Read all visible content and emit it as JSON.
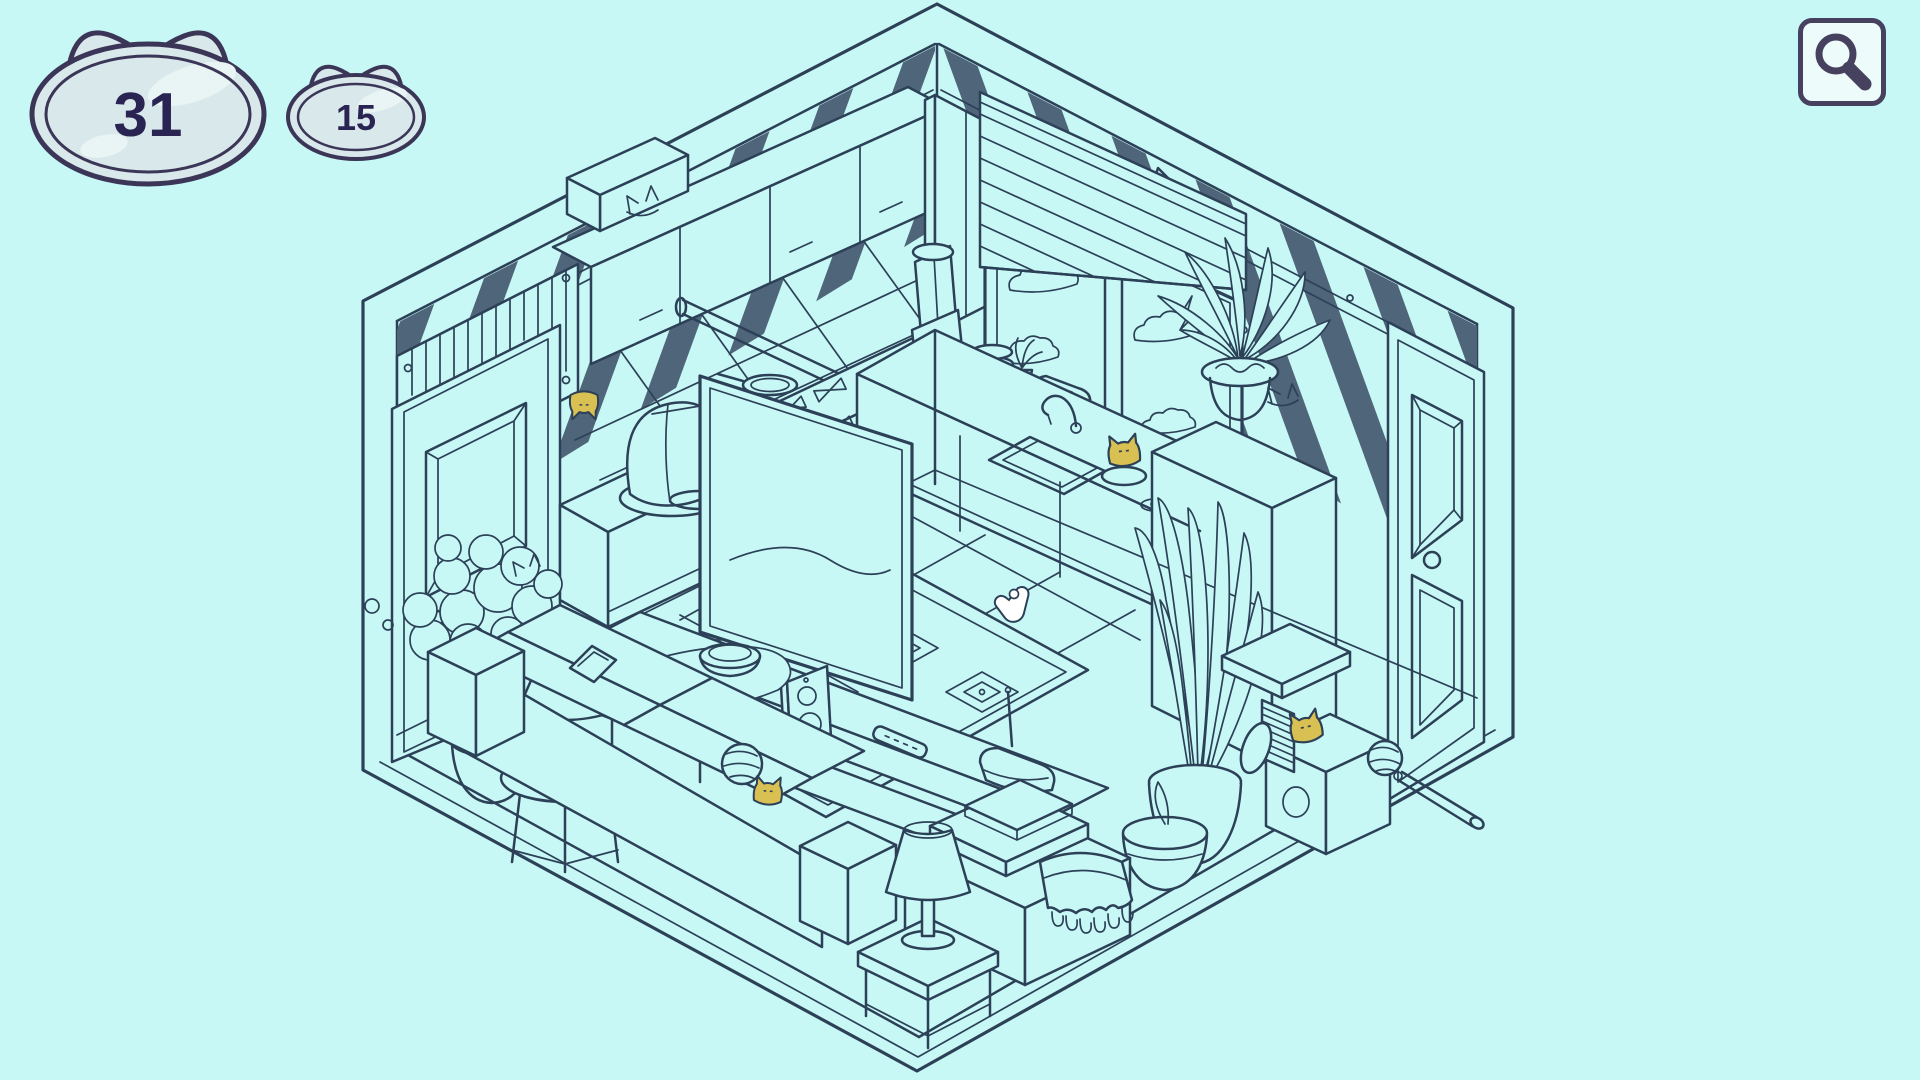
{
  "hud": {
    "large_counter": "31",
    "small_counter": "15"
  },
  "toolbar": {
    "magnifier_icon": "magnifying-glass"
  },
  "colors": {
    "background": "#c7f8f5",
    "line": "#2c4057",
    "wall_stripe": "#4f6579",
    "badge_fill": "#d9e8ea",
    "badge_highlight": "#e9f4f4",
    "badge_border": "#3b3657",
    "badge_text": "#2a2453",
    "found_cat": "#d9c052",
    "button_bg": "#edfbfa",
    "button_border": "#46415f"
  },
  "scene": {
    "description": "isometric line-art room: kitchen with cabinets, window with blinds, fridge, TV on stand, sofa with rug, plants, lamps, cat tree; hidden-cat puzzle",
    "cursor": {
      "x": 1022,
      "y": 612
    },
    "found_cats": [
      {
        "x": 584,
        "y": 404,
        "rotation": 180,
        "scale": 0.9,
        "label": "found-cat-under-cabinet"
      },
      {
        "x": 1124,
        "y": 452,
        "rotation": -6,
        "scale": 1.0,
        "label": "found-cat-in-bowl-by-sink"
      },
      {
        "x": 768,
        "y": 792,
        "rotation": 4,
        "scale": 0.9,
        "label": "found-cat-behind-sofa"
      },
      {
        "x": 1306,
        "y": 728,
        "rotation": -12,
        "scale": 1.0,
        "label": "found-cat-at-scratching-post"
      }
    ]
  }
}
